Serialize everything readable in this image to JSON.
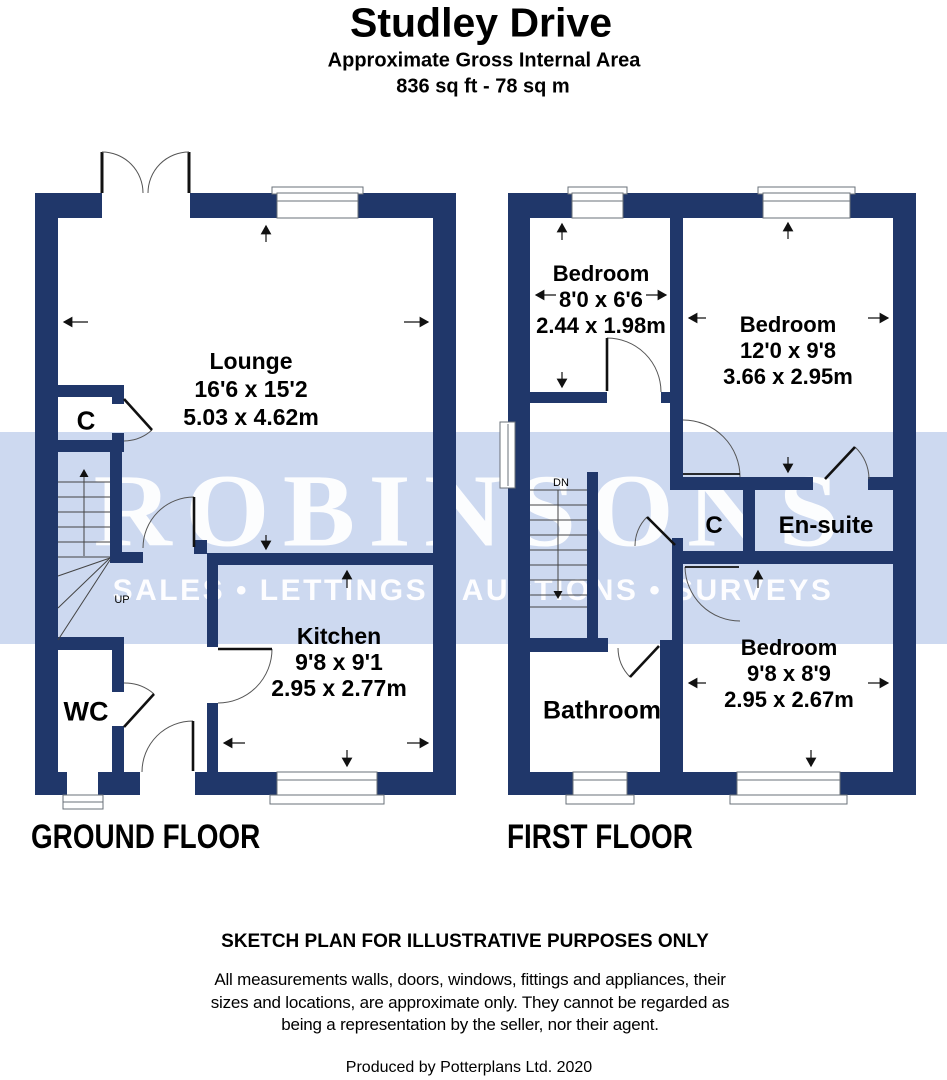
{
  "title": {
    "name": "Studley Drive",
    "subtitle": "Approximate Gross Internal Area",
    "area": "836 sq ft - 78 sq m"
  },
  "watermark": {
    "brand": "ROBINSONS",
    "tagline": "SALES • LETTINGS • AUCTIONS • SURVEYS"
  },
  "floors": {
    "ground": {
      "label": "GROUND FLOOR",
      "rooms": {
        "lounge": {
          "name": "Lounge",
          "imperial": "16'6 x 15'2",
          "metric": "5.03 x 4.62m"
        },
        "kitchen": {
          "name": "Kitchen",
          "imperial": "9'8 x 9'1",
          "metric": "2.95 x 2.77m"
        },
        "wc": "WC",
        "cupboard": "C",
        "stair_direction": "UP"
      }
    },
    "first": {
      "label": "FIRST FLOOR",
      "rooms": {
        "bedroom1": {
          "name": "Bedroom",
          "imperial": "8'0 x 6'6",
          "metric": "2.44 x 1.98m"
        },
        "bedroom2": {
          "name": "Bedroom",
          "imperial": "12'0 x 9'8",
          "metric": "3.66 x 2.95m"
        },
        "bedroom3": {
          "name": "Bedroom",
          "imperial": "9'8 x 8'9",
          "metric": "2.95 x 2.67m"
        },
        "bathroom": "Bathroom",
        "ensuite": "En-suite",
        "cupboard": "C",
        "stair_direction": "DN"
      }
    }
  },
  "footer": {
    "disclaimer_title": "SKETCH PLAN FOR ILLUSTRATIVE PURPOSES ONLY",
    "disclaimer_lines": [
      "All measurements walls, doors, windows, fittings and appliances, their",
      "sizes and locations, are approximate only. They cannot be regarded as",
      "being a representation by the seller, nor their agent."
    ],
    "credit": "Produced by Potterplans Ltd. 2020"
  },
  "colors": {
    "wall": "#20376a",
    "watermark_band": "#cdd9f0",
    "watermark_text": "#ffffff",
    "label_text": "#000000"
  }
}
